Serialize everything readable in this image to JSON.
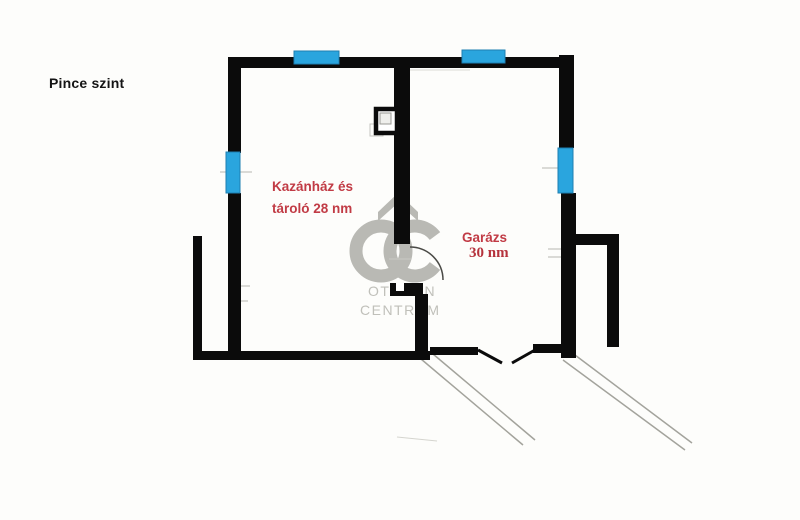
{
  "page": {
    "title": "Pince szint"
  },
  "rooms": {
    "boiler": {
      "line1": "Kazánház és",
      "line2": "tároló 28 nm"
    },
    "garage": {
      "line1": "Garázs",
      "line2": "30 nm"
    }
  },
  "watermark": {
    "logo": "OC",
    "line1": "OTTHON",
    "line2": "CENTRUM"
  },
  "colors": {
    "wall": "#0b0b0b",
    "window": "#2aa5de",
    "window_border": "#1d7fb2",
    "room_label": "#c13b45",
    "watermark": "#b9b9b4",
    "ramp_line": "#a3a39c",
    "background": "#fdfdfb"
  }
}
